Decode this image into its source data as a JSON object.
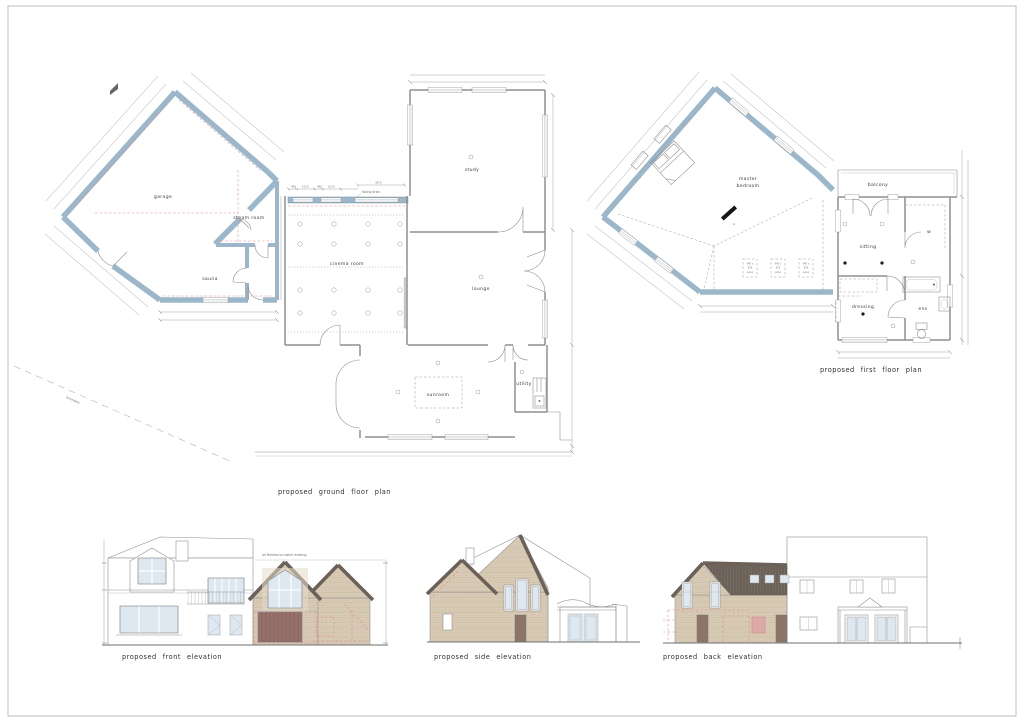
{
  "drawing": {
    "ground_floor": {
      "title": "proposed ground floor plan",
      "rooms": {
        "garage": "garage",
        "steam_room": "steam room",
        "sauna": "sauna",
        "cinema_room": "cinema room",
        "study": "study",
        "lounge": "lounge",
        "sunroom": "sunroom",
        "utility": "utility"
      },
      "notes": {
        "facing_brick": "facing brick",
        "boundary": "boundary"
      },
      "dims": {
        "a": "440",
        "b": "1010",
        "c": "440",
        "d": "1010",
        "e": "3875"
      }
    },
    "first_floor": {
      "title": "proposed first floor plan",
      "rooms": {
        "master_line1": "master",
        "master_line2": "bedroom",
        "balcony": "balcony",
        "sitting": "sitting",
        "dressing": "dressing",
        "ensuite": "ens",
        "wardrobe": "w"
      },
      "notes": {
        "tv": "tv",
        "velux_w": "940 x",
        "velux_h": "550",
        "velux_name": "velux"
      }
    },
    "elevations": {
      "front": {
        "title": "proposed front elevation",
        "note": "all finishes to match existing"
      },
      "side": {
        "title": "proposed side elevation"
      },
      "back": {
        "title": "proposed back elevation"
      }
    },
    "colors": {
      "wall": "#9db7ca",
      "wall_stroke": "#5f7f99",
      "red": "#e08a8a",
      "brick": "#d8cbb6",
      "brick_line": "#c6b59a",
      "roof": "#6b6158",
      "glass": "#dde8f0",
      "garage_door": "#96706a",
      "door_brown": "#8a7566"
    }
  }
}
